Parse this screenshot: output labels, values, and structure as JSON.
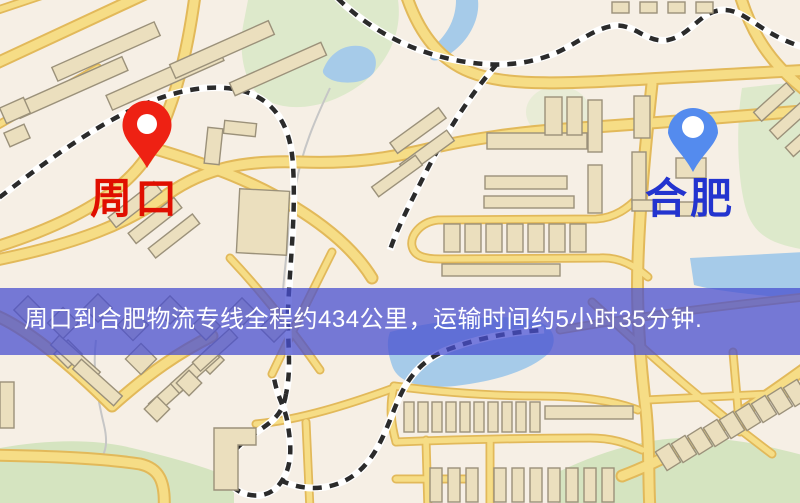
{
  "origin": {
    "label": "周口"
  },
  "destination": {
    "label": "合肥"
  },
  "banner": {
    "text": "周口到合肥物流专线全程约434公里，运输时间约5小时35分钟."
  },
  "colors": {
    "background": "#f6efe5",
    "park": "#dde9cb",
    "park_dark": "#d5e4c0",
    "water": "#a6cbe9",
    "stream": "#c6c6c6",
    "road_fill": "#f6dd86",
    "road_casing": "#e2b95a",
    "building_fill": "#ebdfbe",
    "building_stroke": "#9b917a",
    "rail_dash": "#2b2b2b",
    "origin_pin": "#ee2113",
    "origin_label": "#e00e00",
    "destination_pin": "#548bee",
    "destination_label": "#2334cf",
    "banner_bg": "rgba(72,78,208,0.74)",
    "banner_text": "#ffffff"
  }
}
